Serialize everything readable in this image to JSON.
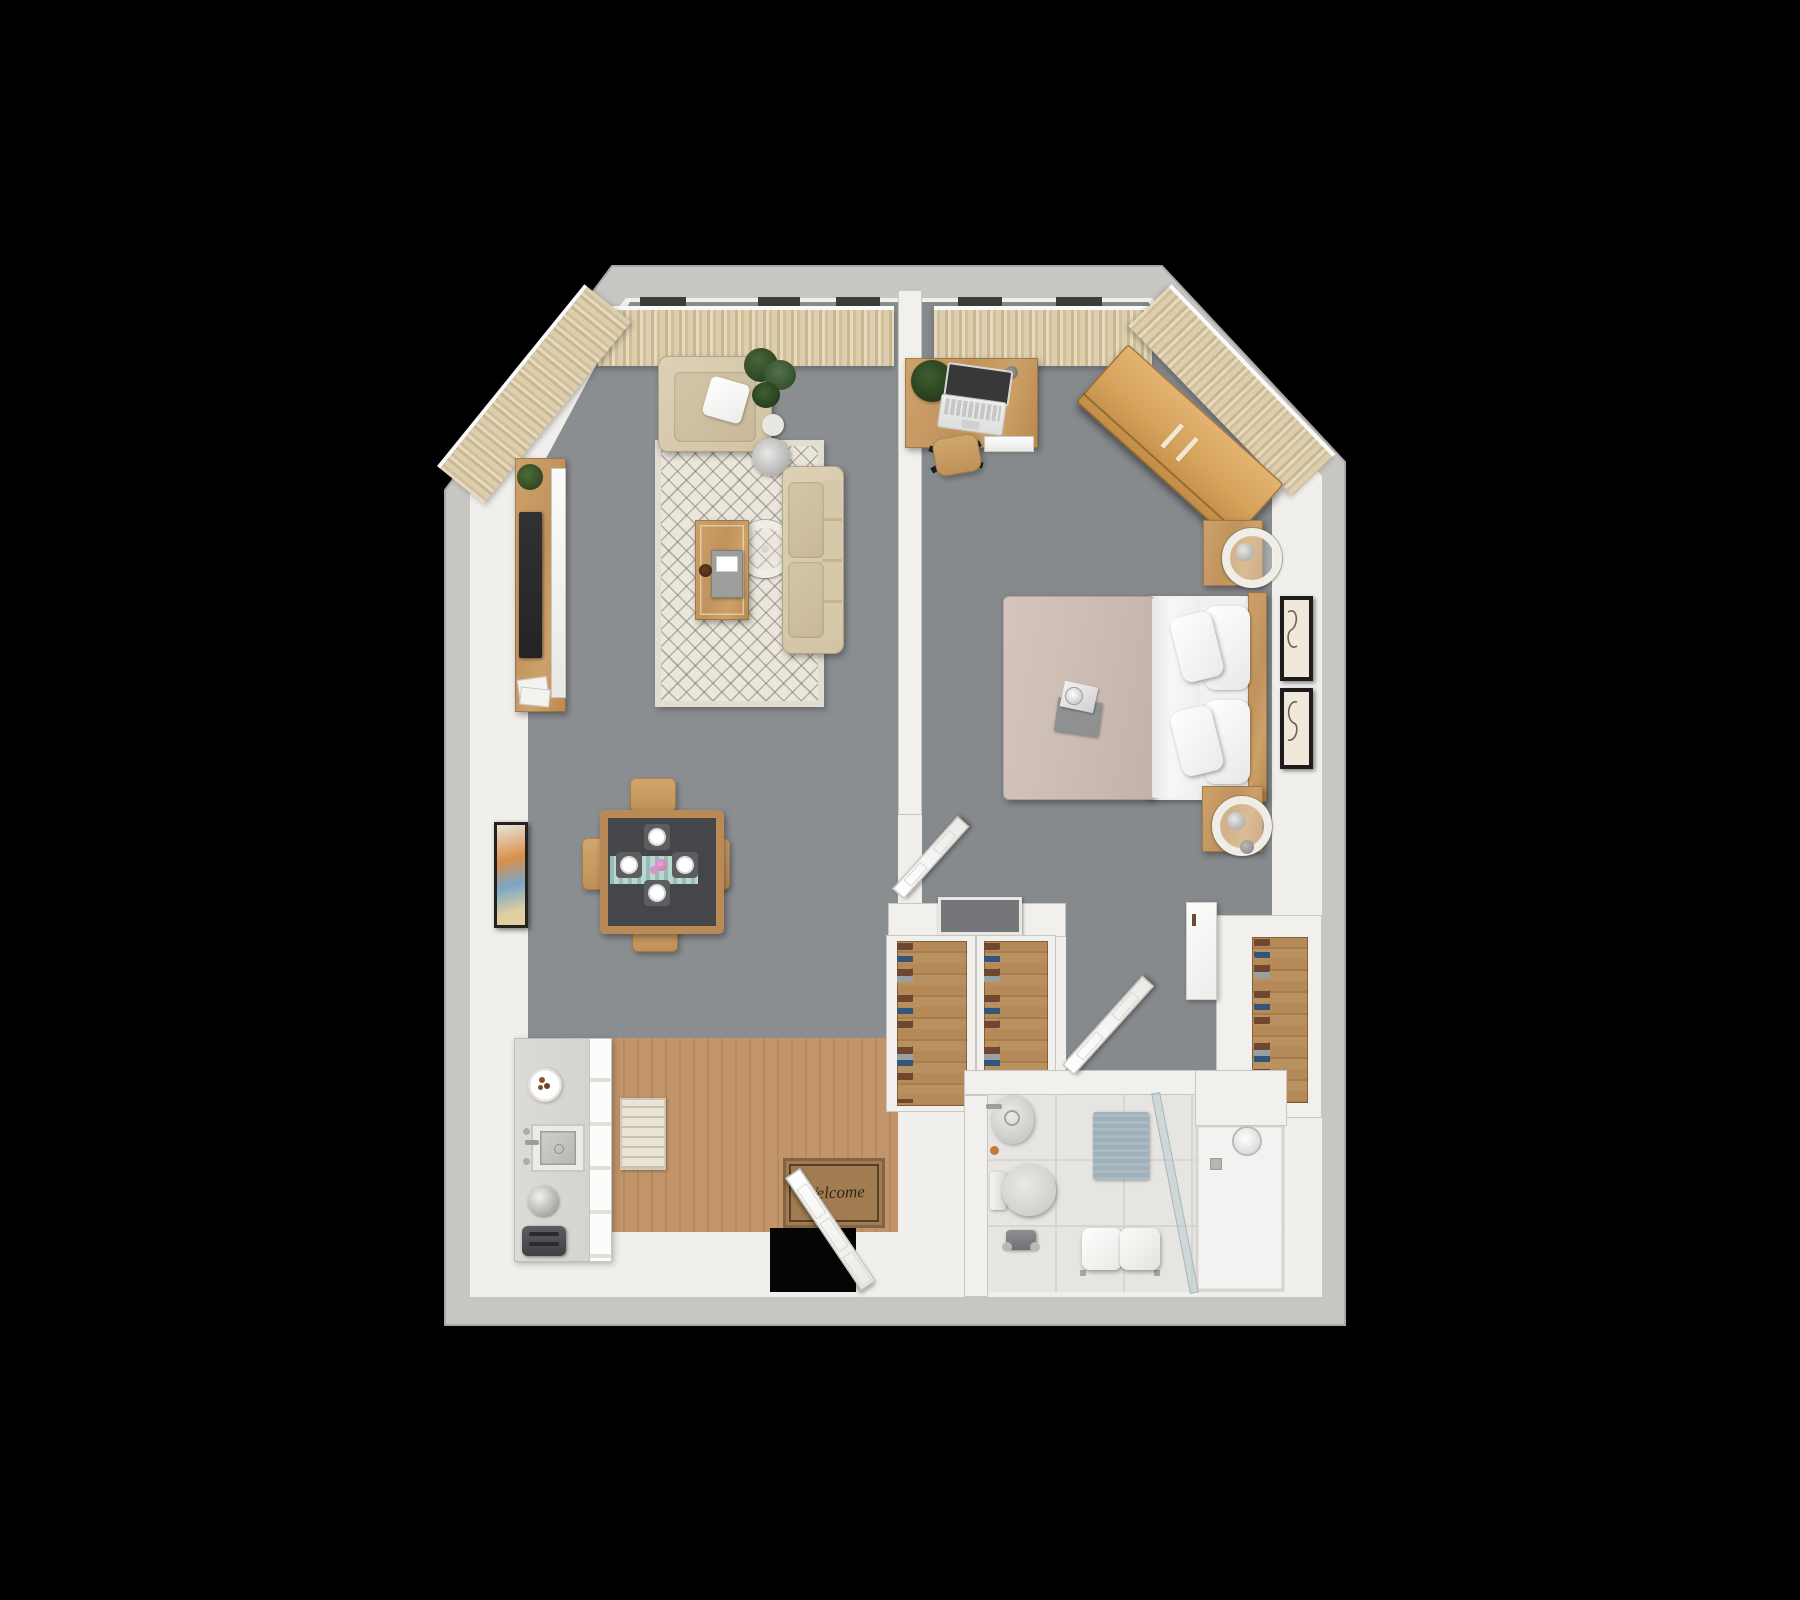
{
  "scene": {
    "type": "3d-rendered-floor-plan",
    "view": "top-down dollhouse render of a one-bedroom apartment",
    "background": "#000000"
  },
  "entry": {
    "mat_text": "Welcome",
    "items": [
      "front-door (open)",
      "welcome-mat",
      "black-doorway-gap"
    ]
  },
  "palette": {
    "outer_wall": "#c7c6c3",
    "inner_wall": "#f1efeb",
    "carpet": "#898c8f",
    "wood_floor": "#c2946a",
    "furniture_wood": "#c0955f",
    "wardrobe_wood": "#d9a961",
    "upholstery_beige": "#d7caae",
    "curtain_beige": "#dccfae",
    "rug_cream": "#e9e5da",
    "bed_blanket_mauve": "#cfc0b8",
    "linens_white": "#f4f3f1",
    "bathroom_tile": "#e6e5e2",
    "bath_mat_blue": "#9fb0bb",
    "table_runner_teal": "#b9d6cf",
    "flowers_pink": "#d893c8",
    "tv_dark": "#2e2e30"
  },
  "rooms": [
    {
      "id": "living-room",
      "floor": "gray carpet",
      "furniture": [
        "tv-console",
        "television",
        "console-plant",
        "magazine-stack",
        "area-rug",
        "armchair",
        "throw-pillow",
        "floor-plant",
        "arc-floor-lamp",
        "coffee-table",
        "serving-tray",
        "coaster",
        "sofa",
        "dining-table",
        "dining-chair x4",
        "table-runner",
        "place-setting x4",
        "flower-bouquet",
        "wall-art"
      ]
    },
    {
      "id": "kitchen",
      "floor": "wood planks + white tile",
      "furniture": [
        "kitchen-counter",
        "cabinet-fronts",
        "snack-plate",
        "sink",
        "faucet",
        "kettle",
        "toaster",
        "runner-rug"
      ]
    },
    {
      "id": "bedroom",
      "floor": "gray carpet",
      "furniture": [
        "desk",
        "laptop",
        "desk-plant",
        "desk-cup",
        "desk-drawer",
        "desk-chair",
        "wardrobe (angled)",
        "bed",
        "duvet",
        "sheet-fold",
        "pillow x4",
        "headboard",
        "book-and-mug",
        "nightstand x2",
        "sphere-lamp x2",
        "wall-frame x2",
        "bedroom-door (open)"
      ]
    },
    {
      "id": "hall-closets",
      "furniture": [
        "glass-top-counter",
        "shoe-closet-a",
        "shoe-closet-b",
        "walk-in-shoe-closet",
        "wall-cabinet",
        "floor-vent"
      ]
    },
    {
      "id": "bathroom",
      "floor": "speckled tile",
      "furniture": [
        "vanity-sink",
        "soap",
        "toilet",
        "toilet-paper-holder",
        "bath-mat",
        "towel-bench",
        "shower-tray",
        "shower-head",
        "shower-drain",
        "glass-partition",
        "bathroom-door (open)"
      ]
    }
  ],
  "windows": {
    "treatment": "beige pinch-pleat curtains on white rails",
    "locations": [
      "living top wall",
      "living angled corner wall",
      "bedroom top wall",
      "bedroom angled corner wall"
    ]
  }
}
